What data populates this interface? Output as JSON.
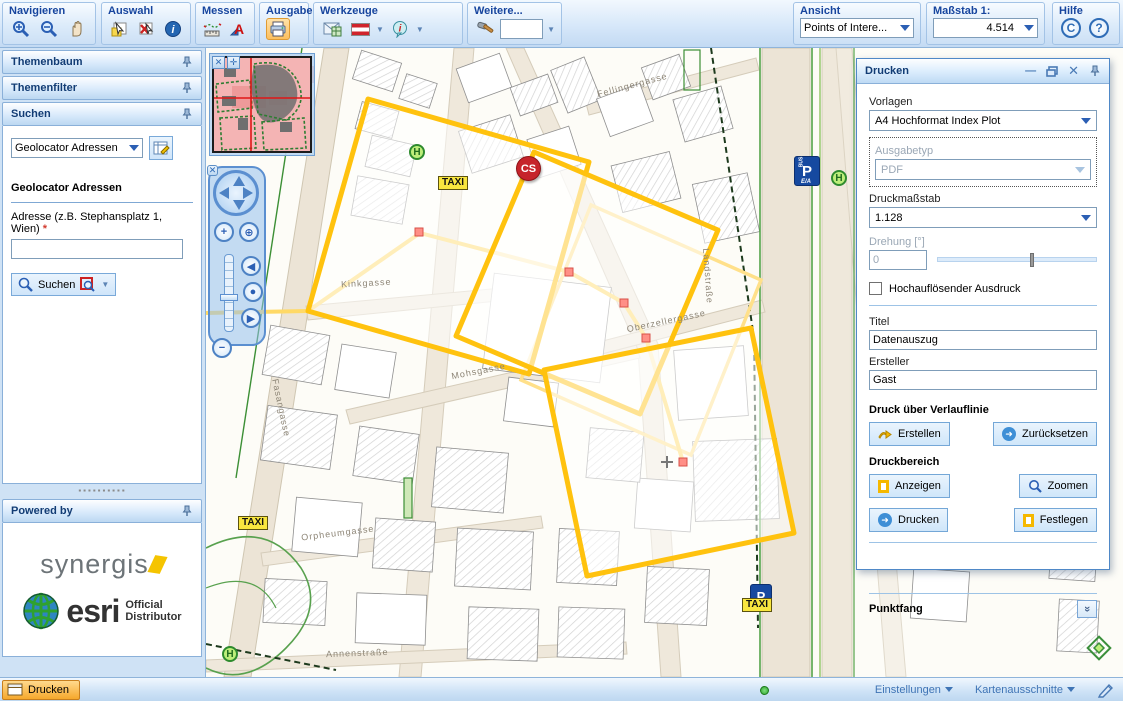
{
  "toolbar": {
    "navigieren": "Navigieren",
    "auswahl": "Auswahl",
    "messen": "Messen",
    "ausgabe": "Ausgabe",
    "werkzeuge": "Werkzeuge",
    "weitere": "Weitere...",
    "ansicht": "Ansicht",
    "ansicht_value": "Points of Intere...",
    "massstab": "Maßstab 1:",
    "massstab_value": "4.514",
    "hilfe": "Hilfe",
    "c_button": "C",
    "help_button": "?"
  },
  "sidebar": {
    "themenbaum": "Themenbaum",
    "themenfilter": "Themenfilter",
    "suchen": "Suchen",
    "search": {
      "selector_value": "Geolocator Adressen",
      "section_title": "Geolocator Adressen",
      "address_label_line1": "Adresse (z.B. Stephansplatz 1,",
      "address_label_line2": "Wien)",
      "required_mark": "*",
      "input_value": "",
      "search_button": "Suchen"
    },
    "powered_by": {
      "title": "Powered by",
      "brand1": "synergis",
      "brand2": "esri",
      "brand2_sub1": "Official",
      "brand2_sub2": "Distributor"
    }
  },
  "print_panel": {
    "title": "Drucken",
    "vorlagen_label": "Vorlagen",
    "vorlagen_value": "A4 Hochformat Index Plot",
    "ausgabetyp_label": "Ausgabetyp",
    "ausgabetyp_value": "PDF",
    "druckmassstab_label": "Druckmaßstab",
    "druckmassstab_value": "1.128",
    "drehung_label": "Drehung [°]",
    "drehung_value": "0",
    "checkbox_label": "Hochauflösender Ausdruck",
    "titel_label": "Titel",
    "titel_value": "Datenauszug",
    "ersteller_label": "Ersteller",
    "ersteller_value": "Gast",
    "verlauflinie_heading": "Druck über Verlauflinie",
    "erstellen_button": "Erstellen",
    "zuruecksetzen_button": "Zurücksetzen",
    "druckbereich_heading": "Druckbereich",
    "anzeigen_button": "Anzeigen",
    "zoomen_button": "Zoomen",
    "drucken_button": "Drucken",
    "festlegen_button": "Festlegen",
    "punktfang_heading": "Punktfang"
  },
  "map": {
    "taxi": "TAXI",
    "cs": "CS",
    "stop": "H",
    "parking": "P",
    "bus": "BUS",
    "ea": "E/A",
    "streets": [
      "Kinkgasse",
      "Mohsgasse",
      "Orpheumgasse",
      "Annenstraße",
      "Fellingergasse",
      "Oberzellergasse",
      "Fasangasse",
      "Landstraße"
    ]
  },
  "taskbar": {
    "drucken": "Drucken",
    "einstellungen": "Einstellungen",
    "kartenausschnitte": "Kartenausschnitte"
  },
  "colors": {
    "accent_orange": "#fcbf5e",
    "frame_yellow": "#ffc20e",
    "path_yellow": "#ffd966",
    "panel_blue": "#4f88c7"
  }
}
